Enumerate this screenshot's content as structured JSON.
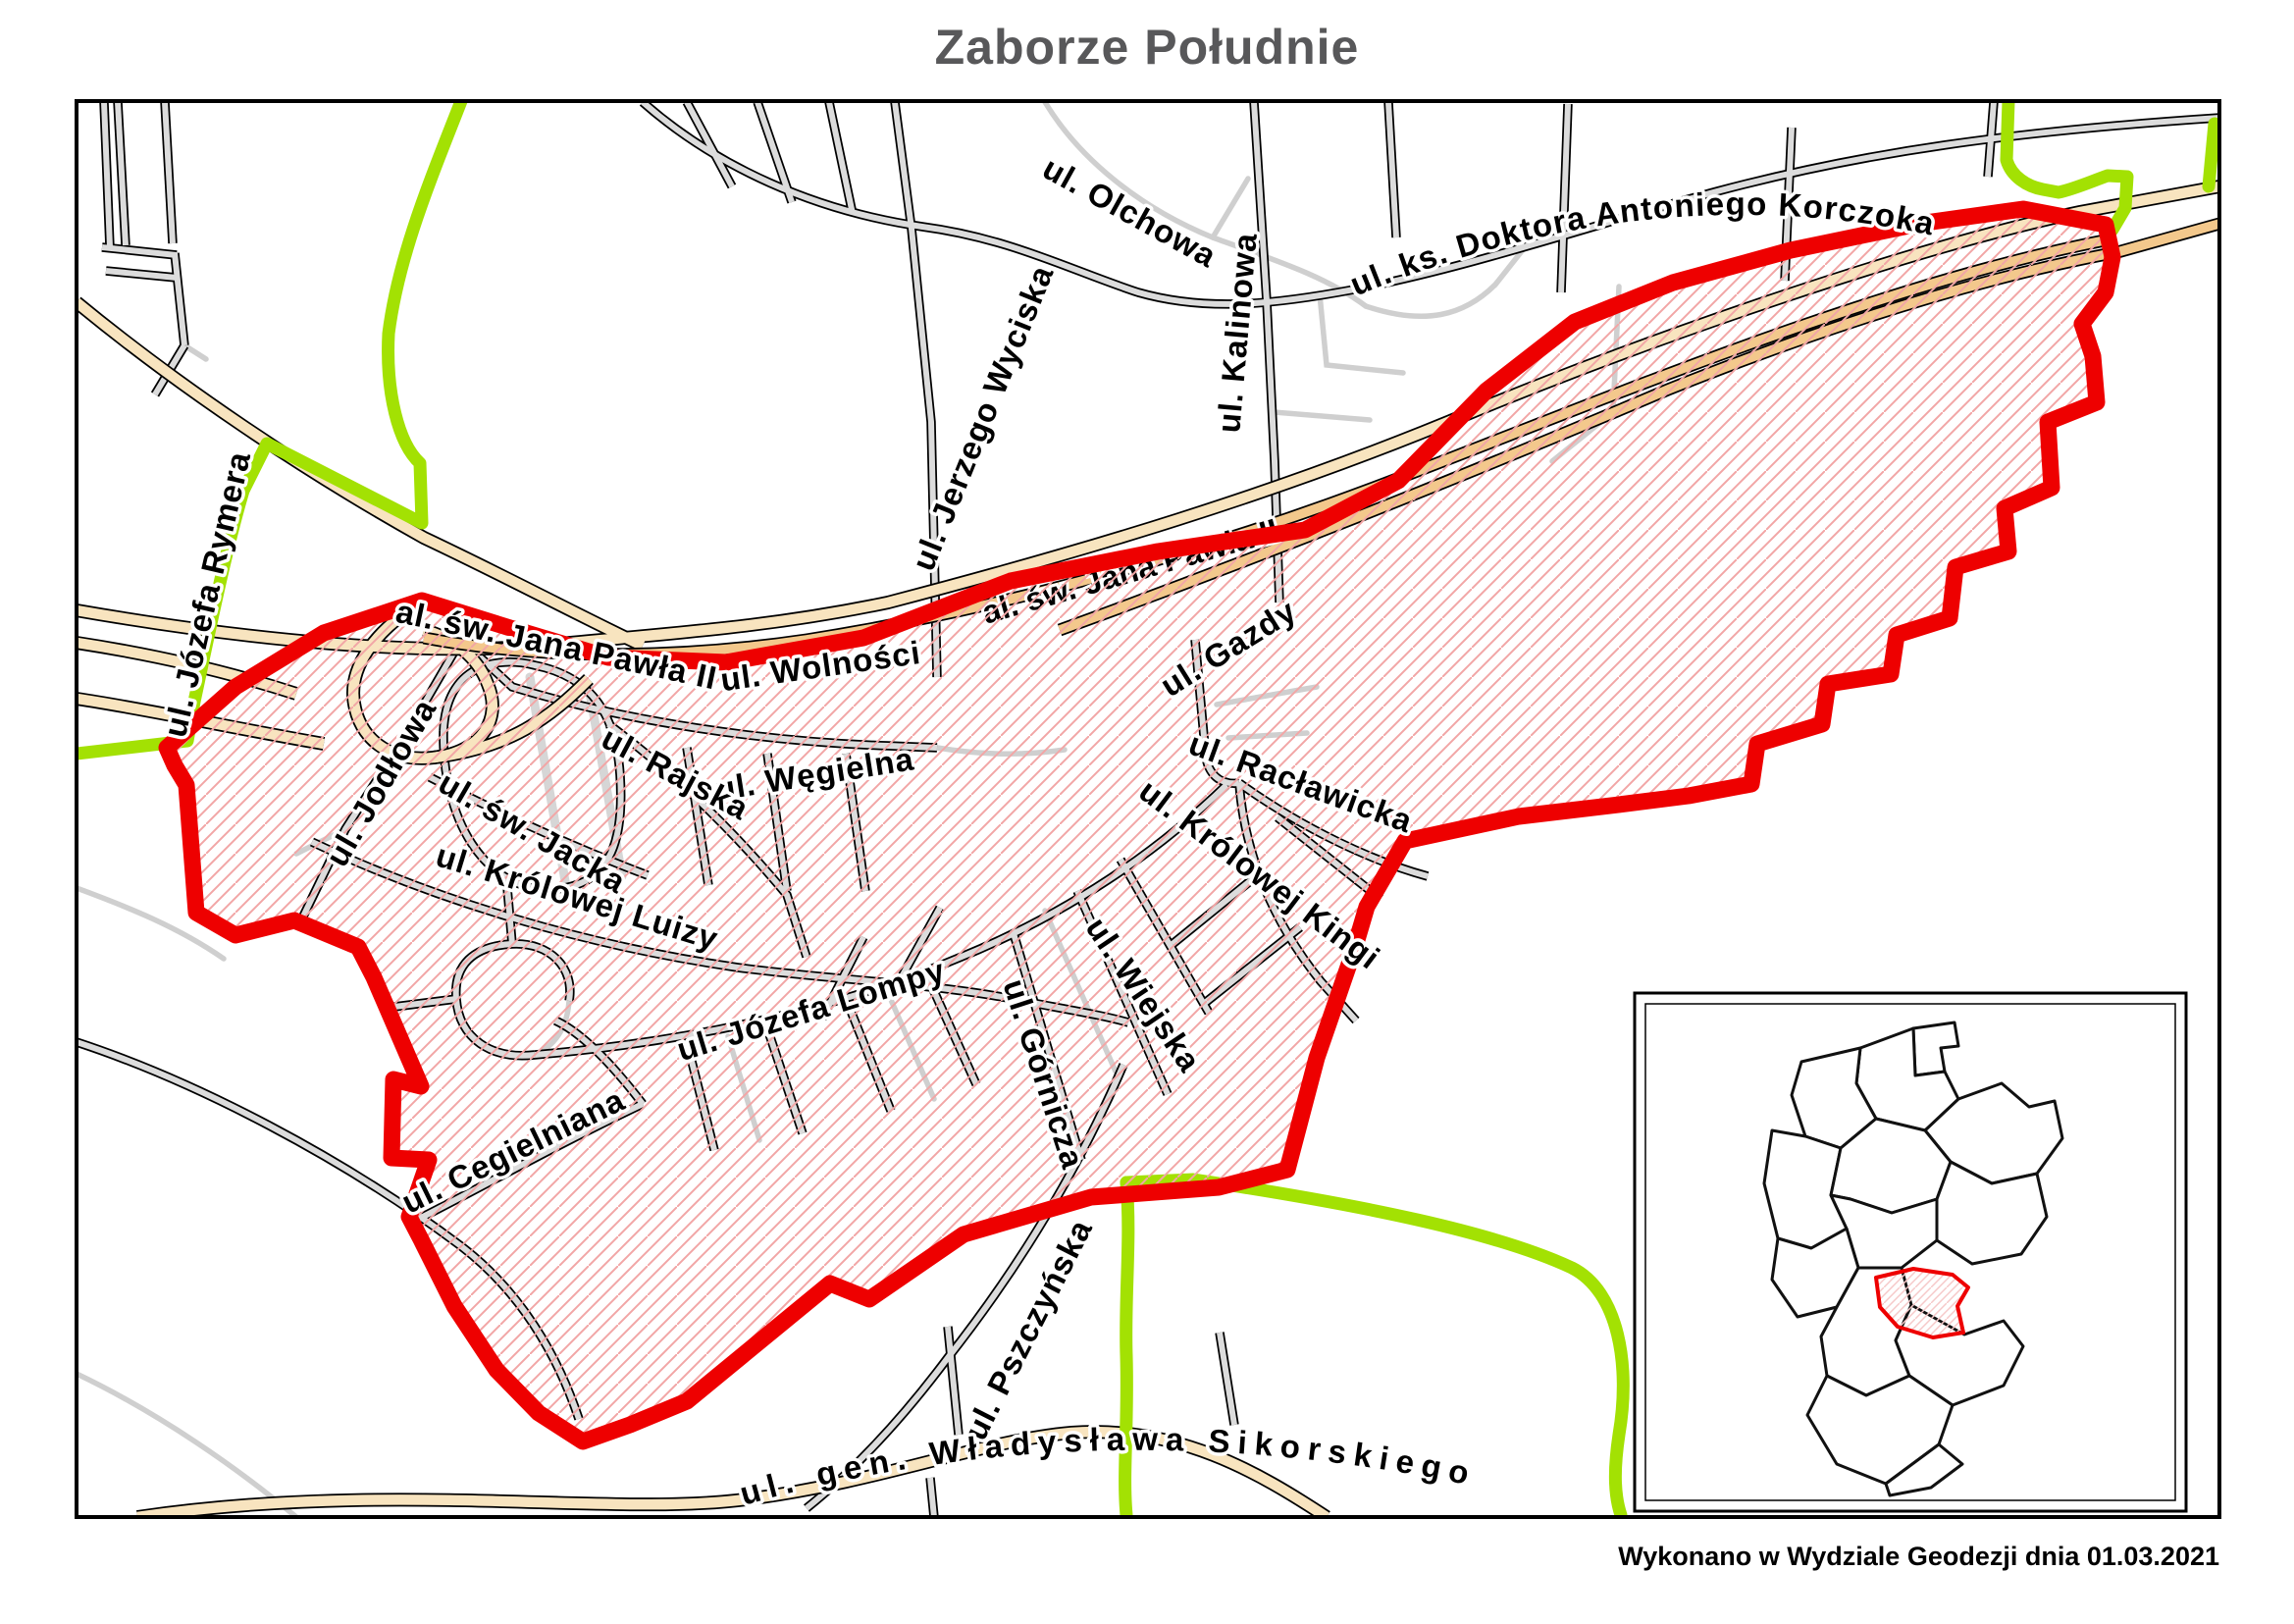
{
  "title": "Zaborze Południe",
  "caption": "Wykonano w Wydziale Geodezji dnia 01.03.2021",
  "colors": {
    "district_boundary_red": "#ee0000",
    "adjacent_border_green": "#a3e103",
    "main_road_tan": "#f8e4bf",
    "highway_orange": "#f3c88c",
    "road_gray": "#dcdcdc",
    "minor_road_gray": "#cfcfcf",
    "hatch_pink": "#f2a6a6",
    "title_gray": "#58585a",
    "frame_black": "#000000"
  },
  "map": {
    "street_labels": {
      "olchowa": "ul. Olchowa",
      "kalinowa": "ul. Kalinowa",
      "wyciska": "ul. Jerzego Wyciska",
      "korczoka": "ul. ks. Doktora Antoniego Korczoka",
      "rymera": "ul. Józefa Rymera",
      "jana_pawla": "al. św. Jana Pawła II",
      "jana_pawla_2": "al. św. Jana Pawła II",
      "wolnosci": "ul. Wolności",
      "wegielna": "ul. Węgielna",
      "gazdy": "ul. Gazdy",
      "rajska": "ul. Rajska",
      "jodlowa": "ul. Jodłowa",
      "jacka": "ul. św. Jacka",
      "luizy": "ul. Królowej Luizy",
      "raclawicka": "ul. Racławicka",
      "kingi": "ul. Królowej Kingi",
      "wiejska": "ul. Wiejska",
      "gornicza": "ul. Górnicza",
      "lompy": "ul. Józefa Lompy",
      "cegielniana": "ul. Cegielniana",
      "pszczynska": "ul. Pszczyńska",
      "sikorskiego": "ul. gen. Władysława Sikorskiego"
    }
  },
  "inset": {
    "highlighted_district": "Zaborze Południe",
    "highlight_color": "#ee0000"
  }
}
